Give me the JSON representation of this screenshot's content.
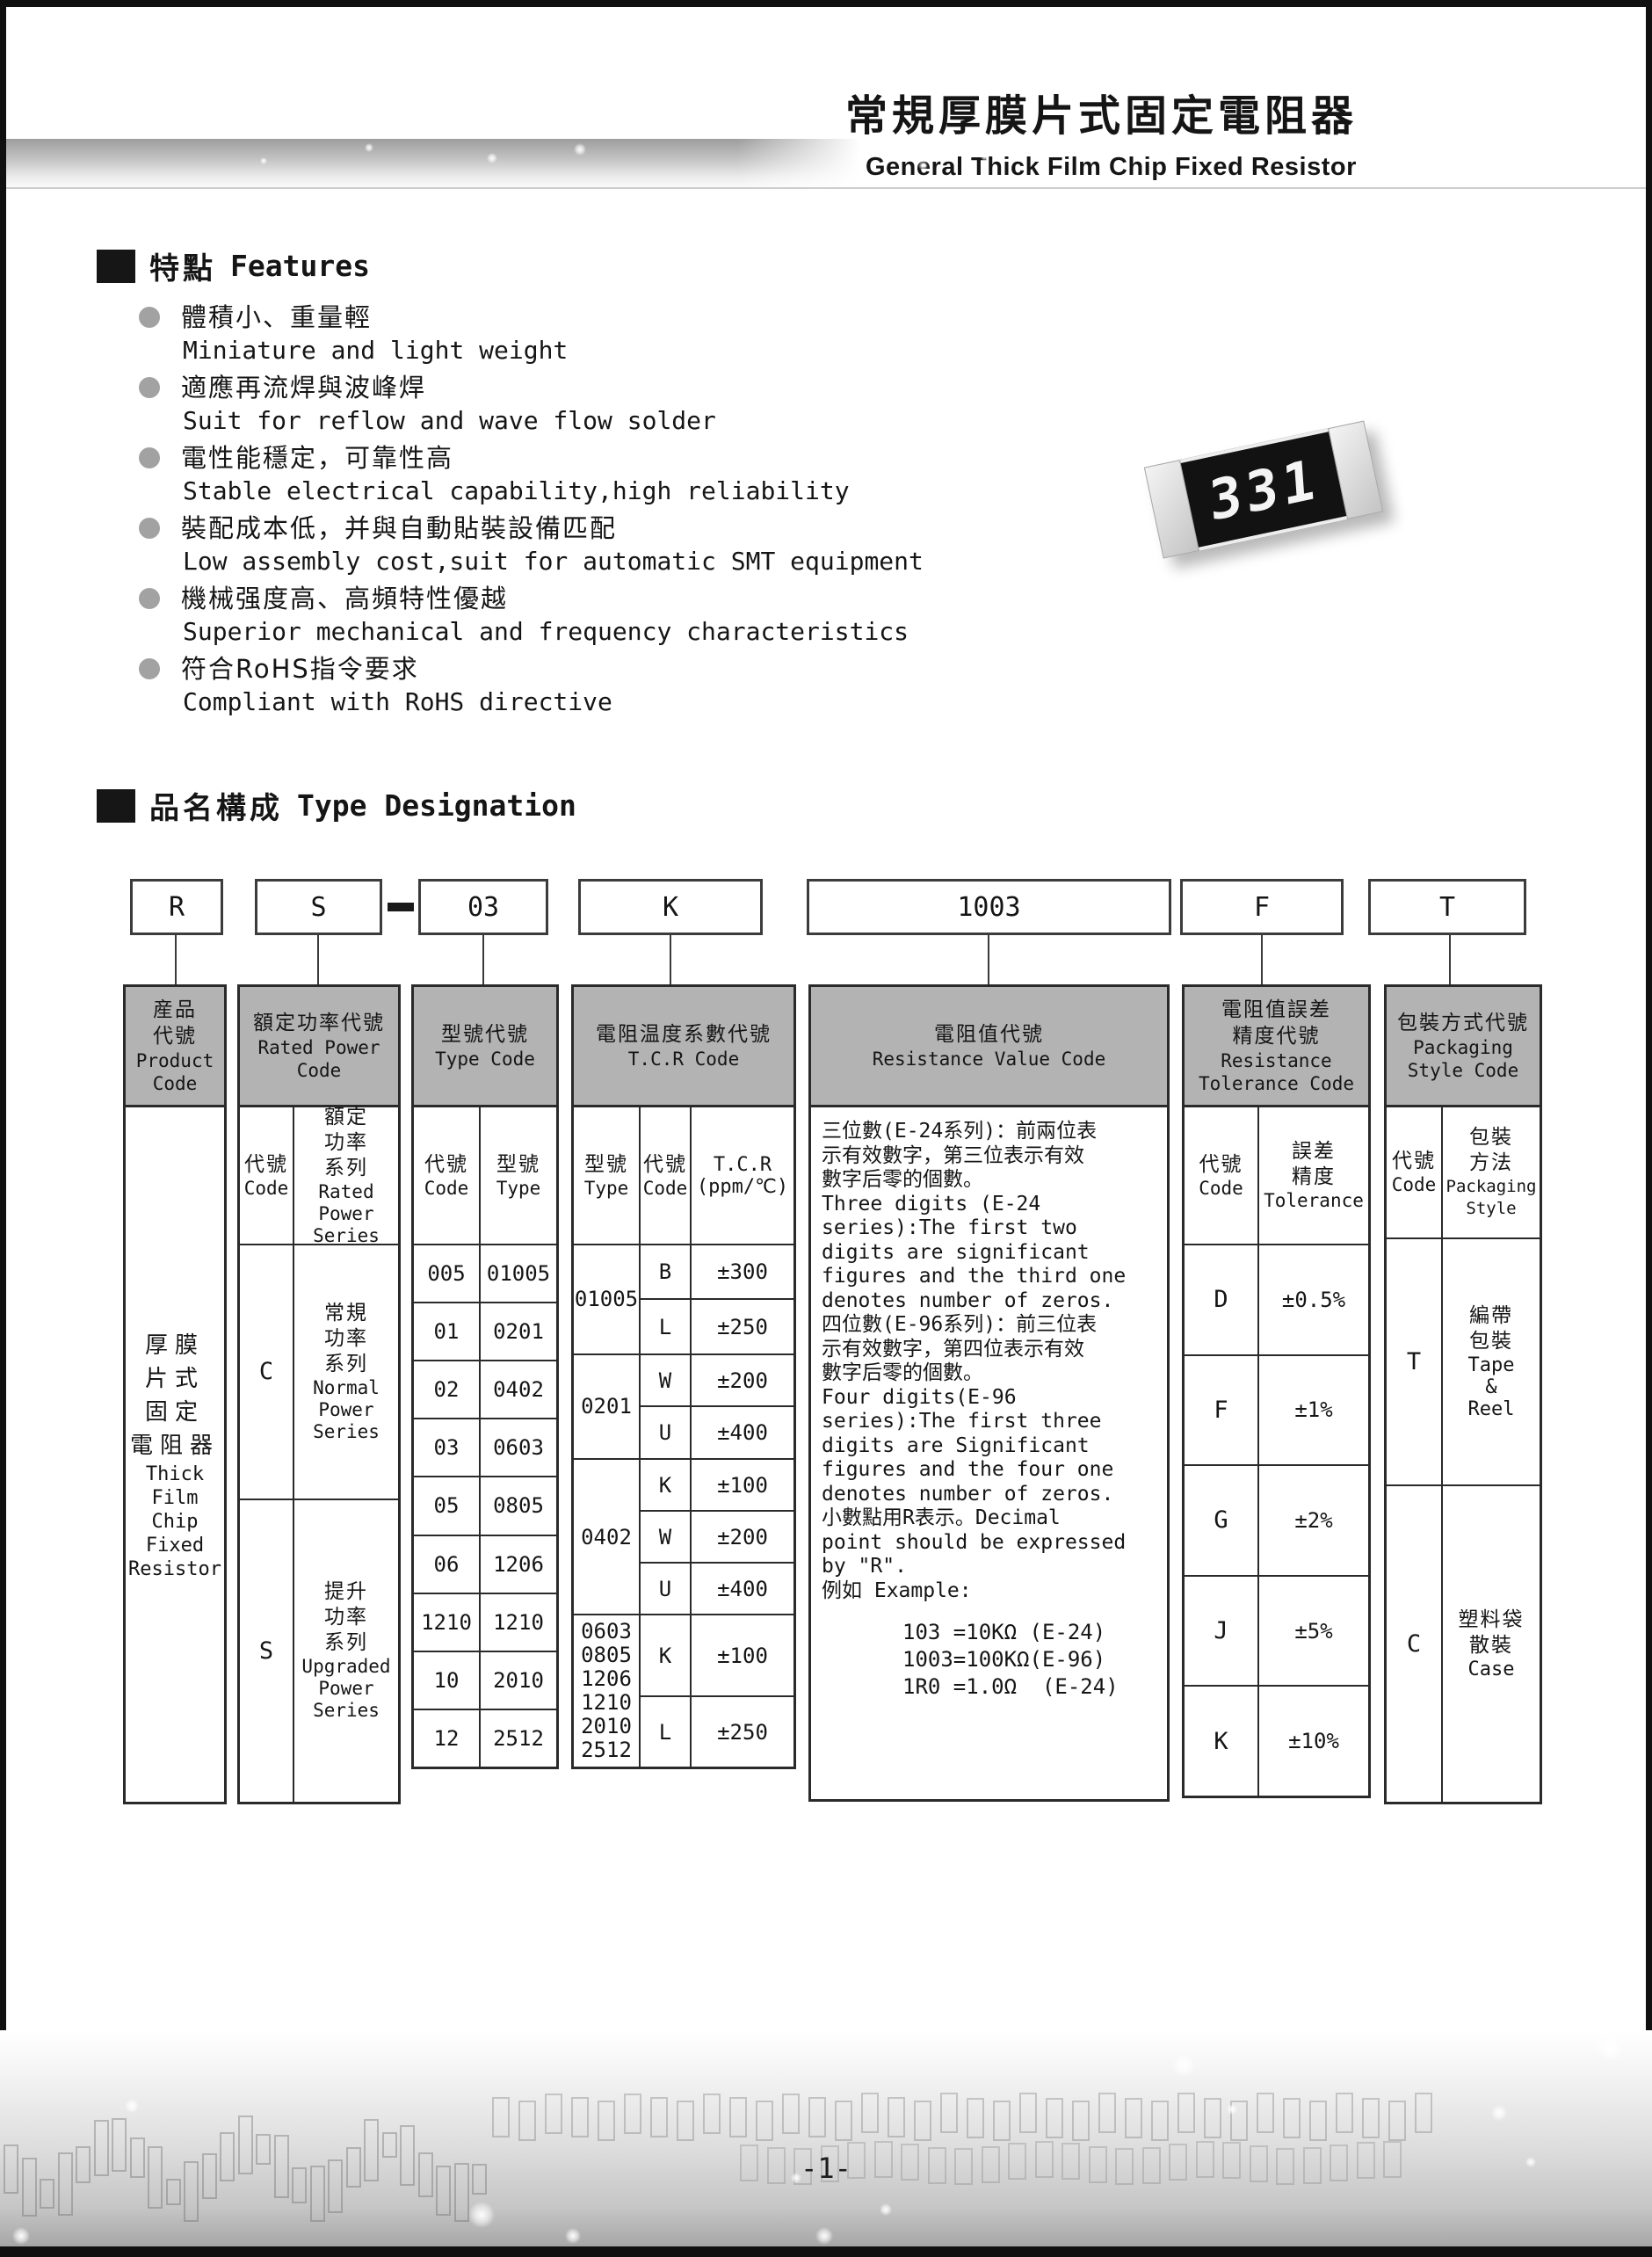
{
  "header": {
    "title_zh": "常規厚膜片式固定電阻器",
    "title_en": "General Thick Film Chip Fixed Resistor"
  },
  "features": {
    "heading_zh": "特點",
    "heading_en": "Features",
    "items": [
      {
        "zh": "體積小、重量輕",
        "en": "Miniature and light weight"
      },
      {
        "zh": "適應再流焊與波峰焊",
        "en": "Suit for reflow and wave flow solder"
      },
      {
        "zh": "電性能穩定，可靠性高",
        "en": "Stable electrical capability,high reliability"
      },
      {
        "zh": "裝配成本低，并與自動貼裝設備匹配",
        "en": "Low assembly cost,suit for automatic SMT equipment"
      },
      {
        "zh": "機械强度高、高頻特性優越",
        "en": "Superior mechanical and frequency characteristics"
      },
      {
        "zh": "符合RoHS指令要求",
        "en": "Compliant with RoHS directive"
      }
    ]
  },
  "resistor": {
    "marking": "331"
  },
  "designation": {
    "heading_zh": "品名構成",
    "heading_en": "Type Designation",
    "codes": [
      "R",
      "S",
      "03",
      "K",
      "1003",
      "F",
      "T"
    ],
    "separator": "-",
    "product": {
      "header_zh": "産品\n代號",
      "header_en": "Product\nCode",
      "body_zh": "厚膜\n片式\n固定\n電阻器",
      "body_en": "Thick\nFilm\nChip\nFixed\nResistor"
    },
    "rated_power": {
      "header_zh": "額定功率代號",
      "header_en": "Rated Power\nCode",
      "code_label_zh": "代號",
      "code_label_en": "Code",
      "series_label_zh": "額定\n功率\n系列",
      "series_label_en": "Rated\nPower\nSeries",
      "rows": [
        {
          "code": "C",
          "zh": "常規\n功率\n系列",
          "en": "Normal\nPower\nSeries"
        },
        {
          "code": "S",
          "zh": "提升\n功率\n系列",
          "en": "Upgraded\nPower\nSeries"
        }
      ]
    },
    "type_code": {
      "header_zh": "型號代號",
      "header_en": "Type Code",
      "code_label_zh": "代號",
      "code_label_en": "Code",
      "type_label_zh": "型號",
      "type_label_en": "Type",
      "rows": [
        [
          "005",
          "01005"
        ],
        [
          "01",
          "0201"
        ],
        [
          "02",
          "0402"
        ],
        [
          "03",
          "0603"
        ],
        [
          "05",
          "0805"
        ],
        [
          "06",
          "1206"
        ],
        [
          "1210",
          "1210"
        ],
        [
          "10",
          "2010"
        ],
        [
          "12",
          "2512"
        ]
      ]
    },
    "tcr": {
      "header_zh": "電阻温度系數代號",
      "header_en": "T.C.R Code",
      "type_label_zh": "型號",
      "type_label_en": "Type",
      "code_label_zh": "代號",
      "code_label_en": "Code",
      "value_label": "T.C.R\n(ppm/℃)",
      "groups": [
        {
          "type": "01005",
          "rows": [
            [
              "B",
              "±300"
            ],
            [
              "L",
              "±250"
            ]
          ]
        },
        {
          "type": "0201",
          "rows": [
            [
              "W",
              "±200"
            ],
            [
              "U",
              "±400"
            ]
          ]
        },
        {
          "type": "0402",
          "rows": [
            [
              "K",
              "±100"
            ],
            [
              "W",
              "±200"
            ],
            [
              "U",
              "±400"
            ]
          ]
        },
        {
          "type": "0603\n0805\n1206\n1210\n2010\n2512",
          "rows": [
            [
              "K",
              "±100"
            ],
            [
              "L",
              "±250"
            ]
          ]
        }
      ]
    },
    "resistance": {
      "header_zh": "電阻值代號",
      "header_en": "Resistance Value Code",
      "description": "三位數(E-24系列)：前兩位表\n示有效數字，第三位表示有效\n數字后零的個數。\nThree digits (E-24\nseries):The first two\ndigits are significant\nfigures and the third one\ndenotes number of zeros.\n四位數(E-96系列)：前三位表\n示有效數字，第四位表示有效\n數字后零的個數。\nFour digits(E-96\nseries):The first three\ndigits are Significant\nfigures and the four one\ndenotes number of zeros.\n小數點用R表示。Decimal\npoint should be expressed\nby \"R\".\n例如 Example:",
      "examples": "103 =10KΩ (E-24)\n1003=100KΩ(E-96)\n1R0 =1.0Ω  (E-24)"
    },
    "tolerance": {
      "header_zh": "電阻值誤差\n精度代號",
      "header_en": "Resistance\nTolerance Code",
      "code_label_zh": "代號",
      "code_label_en": "Code",
      "tol_label_zh": "誤差\n精度",
      "tol_label_en": "Tolerance",
      "rows": [
        [
          "D",
          "±0.5%"
        ],
        [
          "F",
          "±1%"
        ],
        [
          "G",
          "±2%"
        ],
        [
          "J",
          "±5%"
        ],
        [
          "K",
          "±10%"
        ]
      ]
    },
    "packaging": {
      "header_zh": "包裝方式代號",
      "header_en": "Packaging\nStyle Code",
      "code_label_zh": "代號",
      "code_label_en": "Code",
      "style_label_zh": "包裝\n方法",
      "style_label_en": "Packaging\nStyle",
      "rows": [
        {
          "code": "T",
          "zh": "編帶\n包裝",
          "en": "Tape\n&\nReel"
        },
        {
          "code": "C",
          "zh": "塑料袋\n散裝",
          "en": "Case"
        }
      ]
    }
  },
  "footer": {
    "page_number": "-1-"
  }
}
